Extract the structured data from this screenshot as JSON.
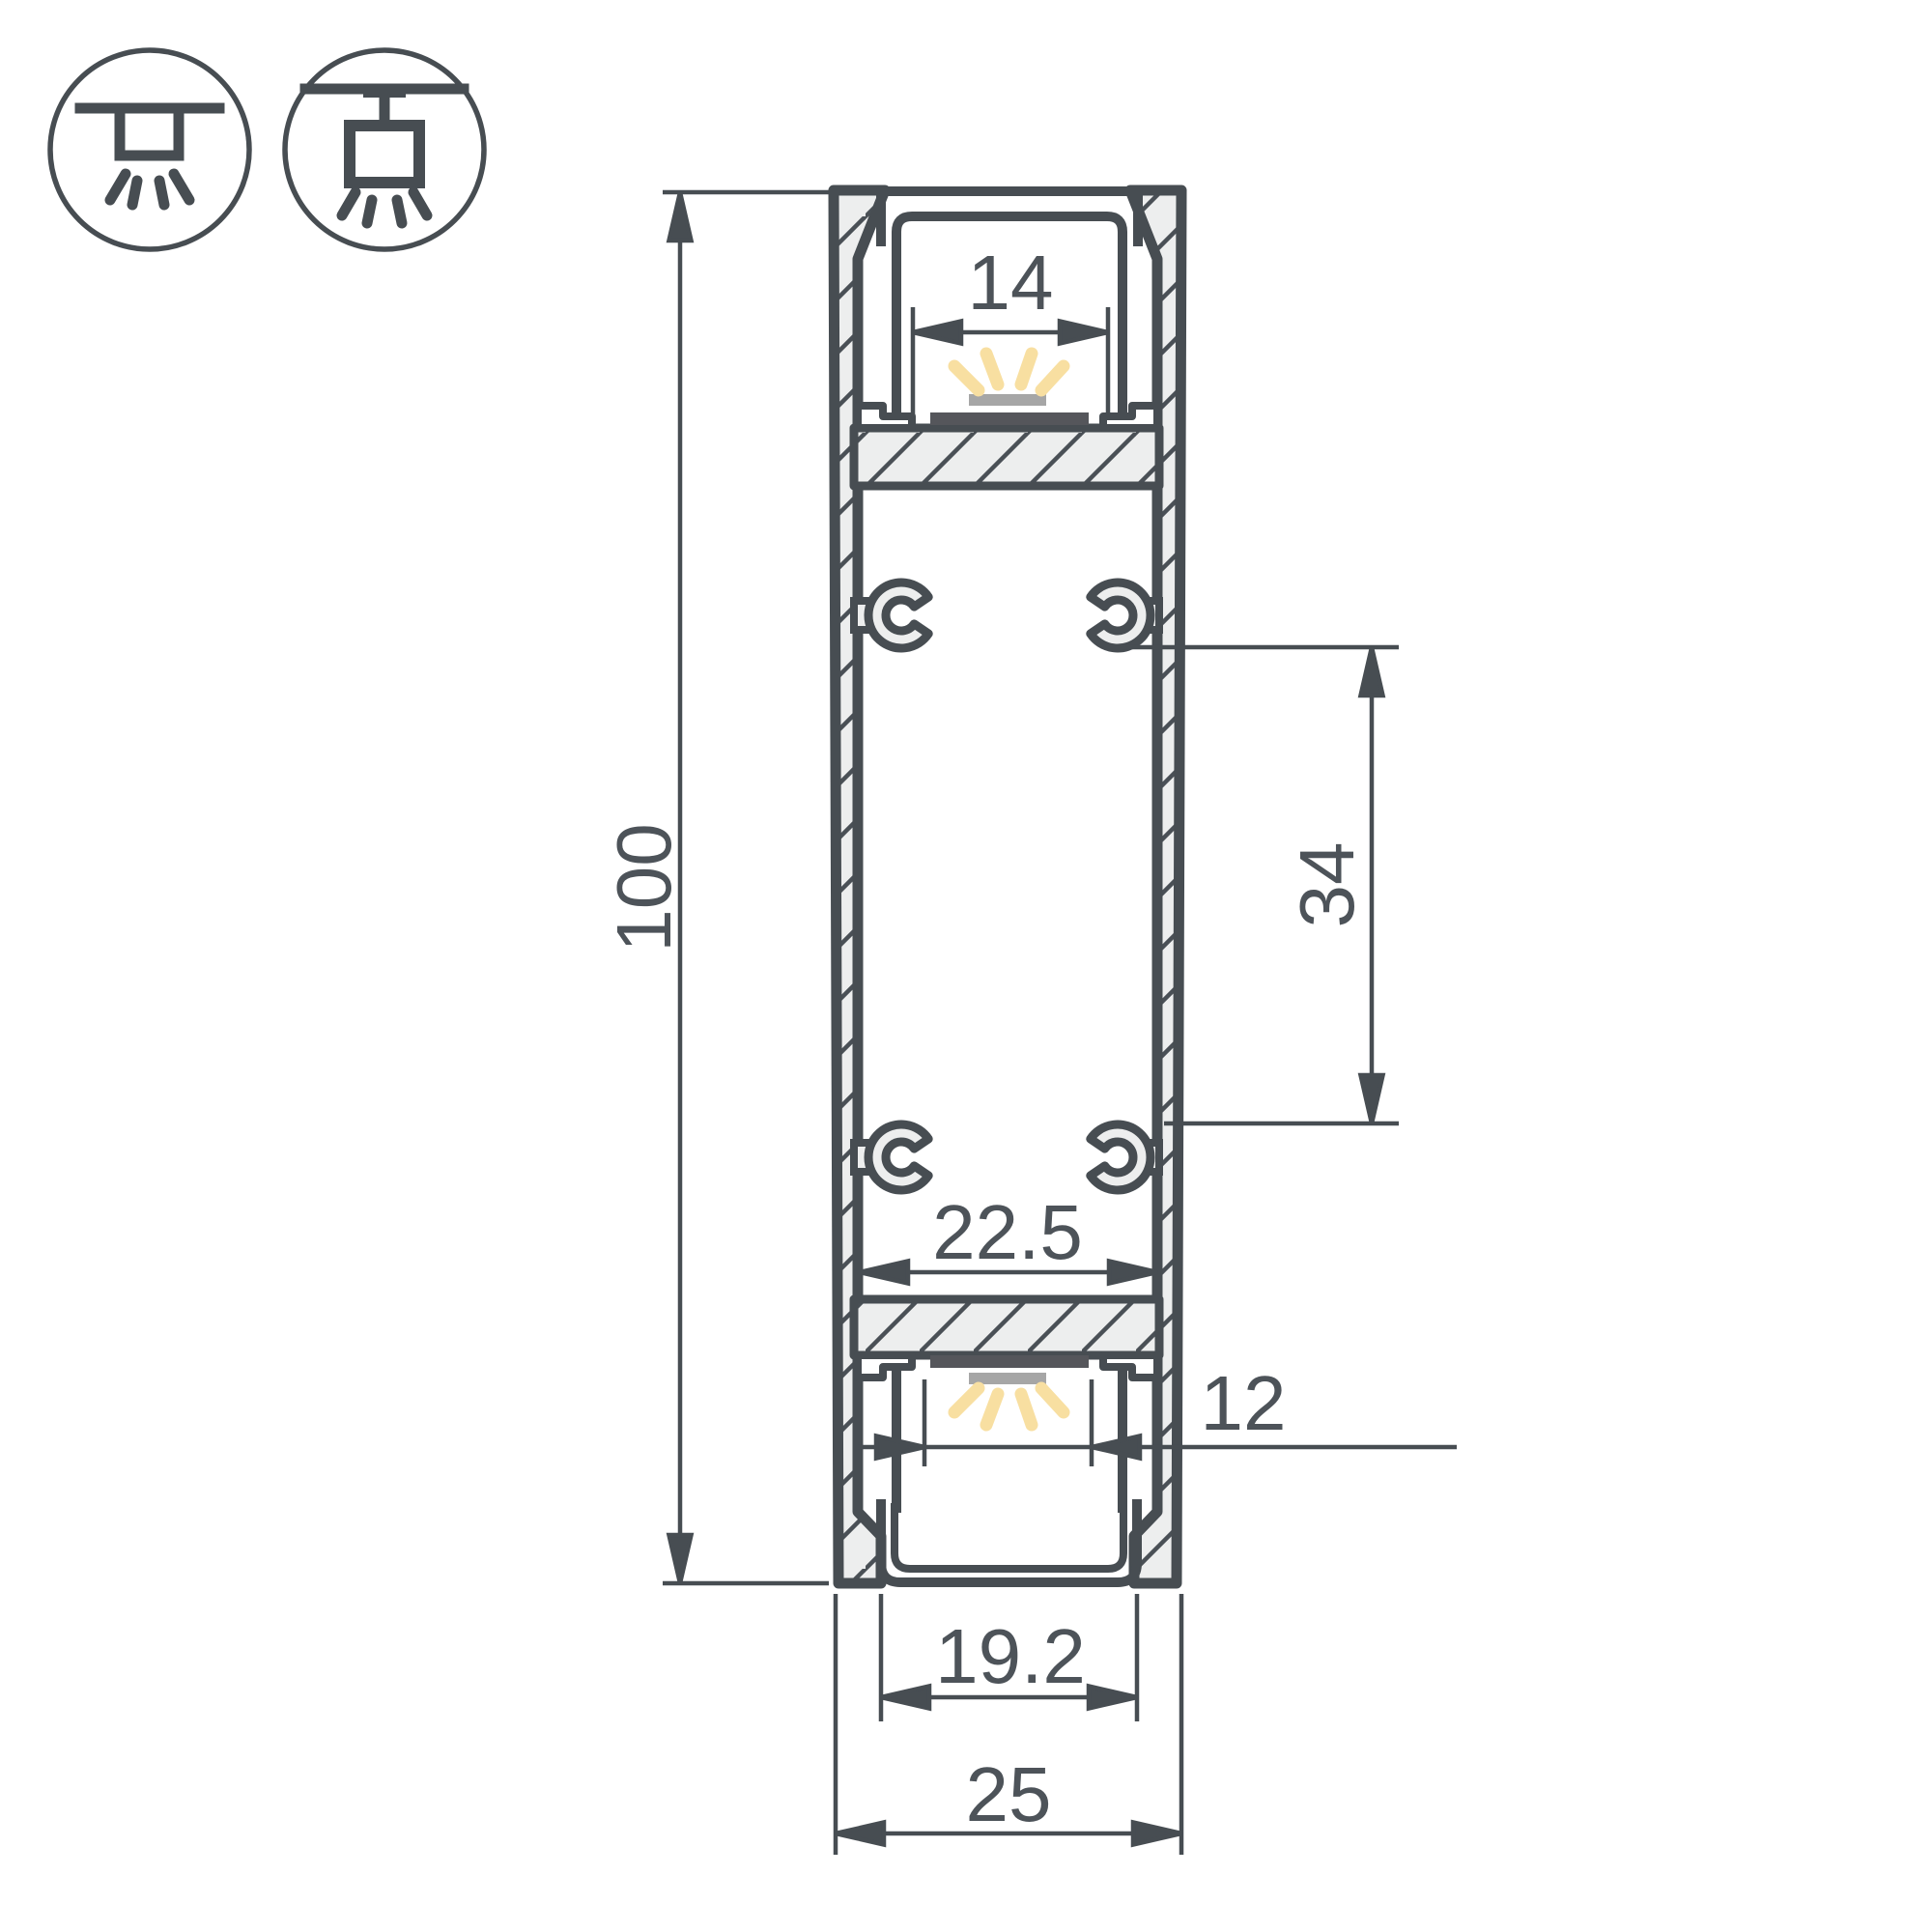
{
  "drawing": {
    "title": "led-profile-cross-section",
    "line_color": "#474D52",
    "hatch_fill": "#EDEEEE",
    "text_color": "#4D5359",
    "led_glow_color": "#F8DFA1",
    "led_emitter_color": "#A6A6A6",
    "led_pcb_color": "#55565B"
  },
  "icons": {
    "recessed_mount": "recessed-ceiling-light-icon",
    "surface_mount": "surface-ceiling-light-icon"
  },
  "dimensions": {
    "overall_height": {
      "label": "100",
      "orientation": "vertical"
    },
    "top_opening": {
      "label": "14",
      "orientation": "horizontal"
    },
    "mount_spacing": {
      "label": "34",
      "orientation": "vertical"
    },
    "inner_width": {
      "label": "22.5",
      "orientation": "horizontal"
    },
    "bottom_led_width": {
      "label": "12",
      "orientation": "horizontal"
    },
    "bottom_opening": {
      "label": "19.2",
      "orientation": "horizontal"
    },
    "overall_width": {
      "label": "25",
      "orientation": "horizontal"
    }
  }
}
